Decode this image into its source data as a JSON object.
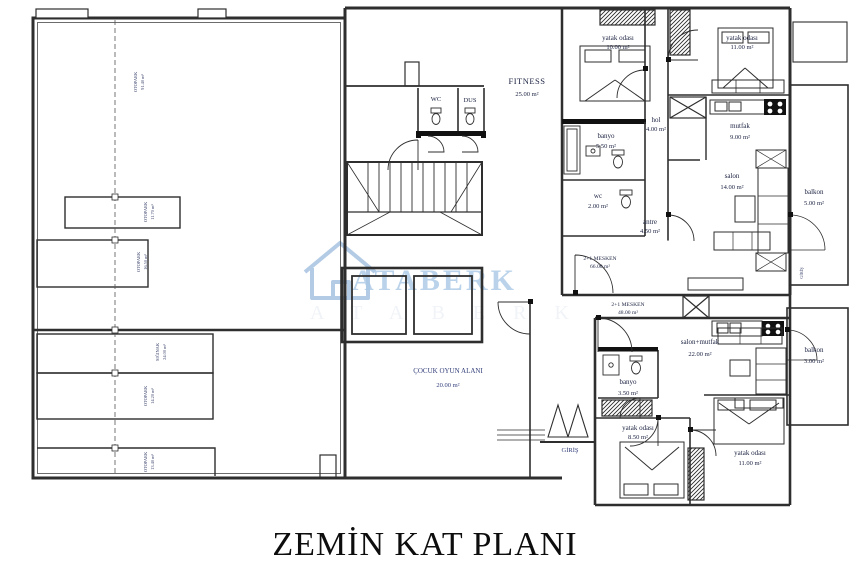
{
  "title": "ZEMİN KAT PLANI",
  "watermark": {
    "brand": "ATABERK",
    "brand_faint": "ATABERK",
    "color": "#9cbfe0"
  },
  "core": {
    "fitness_name": "FITNESS",
    "fitness_area": "25.00 m²",
    "wc": "WC",
    "dus": "DUS",
    "play_name": "ÇOCUK OYUN ALANI",
    "play_area": "20.00 m²",
    "entrance": "GİRİŞ",
    "side_entrance": "GİRİŞ"
  },
  "upper_unit": {
    "type": "2+1 MESKEN",
    "area": "66.00 m²",
    "rooms": {
      "bedroom1_name": "yatak odası",
      "bedroom1_area": "10.00 m²",
      "bedroom2_name": "yatak odası",
      "bedroom2_area": "11.00 m²",
      "hol_name": "hol",
      "hol_area": "4.00 m²",
      "banyo_name": "banyo",
      "banyo_area": "5.50 m²",
      "mutfak_name": "mutfak",
      "mutfak_area": "9.00 m²",
      "wc_name": "wc",
      "wc_area": "2.00 m²",
      "salon_name": "salon",
      "salon_area": "14.00 m²",
      "antre_name": "antre",
      "antre_area": "4.50 m²",
      "balkon_name": "balkon",
      "balkon_area": "5.00 m²"
    }
  },
  "lower_unit": {
    "type": "2+1 MESKEN",
    "area": "48.00 m²",
    "rooms": {
      "salon_name": "salon+mutfak",
      "salon_area": "22.00 m²",
      "banyo_name": "banyo",
      "banyo_area": "3.50 m²",
      "balkon_name": "balkon",
      "balkon_area": "3.00 m²",
      "bedroom1_name": "yatak odası",
      "bedroom1_area": "8.50 m²",
      "bedroom2_name": "yatak odası",
      "bedroom2_area": "11.00 m²"
    }
  },
  "garage": {
    "labels": [
      {
        "l1": "OTOPARK",
        "l2": "91.40 m²"
      },
      {
        "l1": "OTOPARK",
        "l2": "11.70 m²"
      },
      {
        "l1": "OTOPARK",
        "l2": "16.50 m²"
      },
      {
        "l1": "SIĞINAK",
        "l2": "24.00 m²"
      },
      {
        "l1": "OTOPARK",
        "l2": "14.20 m²"
      },
      {
        "l1": "OTOPARK",
        "l2": "13.40 m²"
      }
    ]
  }
}
